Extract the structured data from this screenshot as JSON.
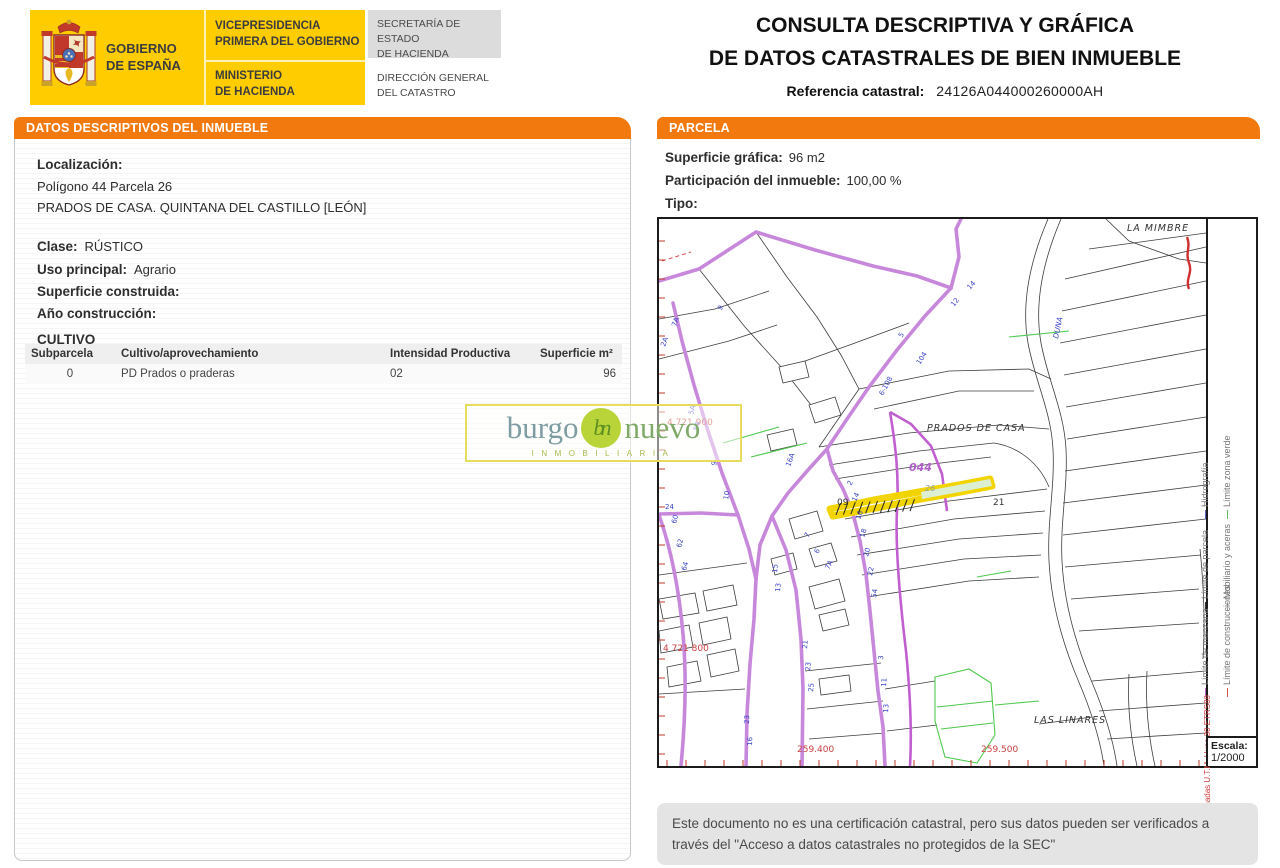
{
  "colors": {
    "accent_orange": "#F1790D",
    "gov_yellow": "#FFCC00",
    "highlight_yellow": "#F2D400"
  },
  "header": {
    "gobierno": "GOBIERNO\nDE ESPAÑA",
    "vicepresidencia": "VICEPRESIDENCIA\nPRIMERA DEL GOBIERNO",
    "ministerio": "MINISTERIO\nDE HACIENDA",
    "secretaria": "SECRETARÍA DE ESTADO\nDE HACIENDA",
    "direccion": "DIRECCIÓN GENERAL\nDEL CATASTRO",
    "title_line1": "CONSULTA DESCRIPTIVA Y GRÁFICA",
    "title_line2": "DE DATOS CATASTRALES DE BIEN INMUEBLE",
    "ref_label": "Referencia catastral:",
    "ref_value": "24126A044000260000AH"
  },
  "left_panel": {
    "header": "DATOS DESCRIPTIVOS DEL INMUEBLE",
    "localizacion_label": "Localización:",
    "localizacion_line1": "Polígono 44 Parcela 26",
    "localizacion_line2": "PRADOS DE CASA. QUINTANA DEL CASTILLO [LEÓN]",
    "clase_label": "Clase:",
    "clase_value": "RÚSTICO",
    "uso_label": "Uso principal:",
    "uso_value": "Agrario",
    "superficie_label": "Superficie construida:",
    "superficie_value": "",
    "ano_label": "Año construcción:",
    "ano_value": "",
    "cultivo_title": "CULTIVO",
    "table": {
      "headers": [
        "Subparcela",
        "Cultivo/aprovechamiento",
        "Intensidad Productiva",
        "Superficie m²"
      ],
      "rows": [
        [
          "0",
          "PD Prados o praderas",
          "02",
          "96"
        ]
      ]
    }
  },
  "right_panel": {
    "header": "PARCELA",
    "superficie_label": "Superficie gráfica:",
    "superficie_value": "96 m2",
    "participacion_label": "Participación del inmueble:",
    "participacion_value": "100,00 %",
    "tipo_label": "Tipo:",
    "tipo_value": ""
  },
  "map": {
    "place_labels": {
      "mimbre": "LA MIMBRE",
      "prados": "PRADOS DE CASA",
      "linares": "LAS LINARES"
    },
    "parcel_labels": {
      "p09": "09",
      "p21": "21",
      "p26": "26",
      "block": "044"
    },
    "coord_labels": {
      "north1": "4 721 900",
      "north2": "4 721 800",
      "east1": "259.400",
      "east2": "259.500"
    },
    "hydro_label": "DUNA",
    "legend": {
      "items": [
        {
          "label": "Hidrografía",
          "color": "#4A5BD0"
        },
        {
          "label": "Límite zona verde",
          "color": "#55BB55"
        },
        {
          "label": "Límite de parcela",
          "color": "#222222"
        },
        {
          "label": "Mobiliario y aceras",
          "color": "#999999"
        },
        {
          "label": "Límite de manzana",
          "color": "#C05FC9"
        },
        {
          "label": "Límite de construcciones",
          "color": "#D04040"
        }
      ],
      "coords_text": "259.600 Coordenadas U.T.M. Huso 30 ETRS89"
    },
    "escala_label": "Escala:",
    "escala_value": "1/2000",
    "road_numbers": [
      {
        "x": 62,
        "y": 92,
        "r": -55,
        "t": "9"
      },
      {
        "x": 17,
        "y": 108,
        "r": -70,
        "t": "7A"
      },
      {
        "x": 6,
        "y": 128,
        "r": -70,
        "t": "2A"
      },
      {
        "x": 34,
        "y": 196,
        "r": -75,
        "t": "5A"
      },
      {
        "x": 39,
        "y": 212,
        "r": -75,
        "t": "54"
      },
      {
        "x": 57,
        "y": 247,
        "r": -78,
        "t": "9"
      },
      {
        "x": 69,
        "y": 281,
        "r": -80,
        "t": "10"
      },
      {
        "x": 243,
        "y": 119,
        "r": -58,
        "t": "5"
      },
      {
        "x": 261,
        "y": 146,
        "r": -58,
        "t": "104"
      },
      {
        "x": 224,
        "y": 177,
        "r": -62,
        "t": "6-108"
      },
      {
        "x": 295,
        "y": 88,
        "r": -52,
        "t": "12"
      },
      {
        "x": 311,
        "y": 71,
        "r": -48,
        "t": "14"
      },
      {
        "x": 118,
        "y": 354,
        "r": -85,
        "t": "15"
      },
      {
        "x": 121,
        "y": 373,
        "r": -85,
        "t": "13"
      },
      {
        "x": 131,
        "y": 248,
        "r": -70,
        "t": "16A"
      },
      {
        "x": 149,
        "y": 319,
        "r": -60,
        "t": "7"
      },
      {
        "x": 159,
        "y": 335,
        "r": -62,
        "t": "6"
      },
      {
        "x": 170,
        "y": 351,
        "r": -64,
        "t": "7A"
      },
      {
        "x": 192,
        "y": 267,
        "r": -62,
        "t": "2"
      },
      {
        "x": 197,
        "y": 283,
        "r": -66,
        "t": "14"
      },
      {
        "x": 201,
        "y": 301,
        "r": -70,
        "t": "16"
      },
      {
        "x": 205,
        "y": 319,
        "r": -72,
        "t": "18"
      },
      {
        "x": 209,
        "y": 338,
        "r": -75,
        "t": "20"
      },
      {
        "x": 213,
        "y": 357,
        "r": -78,
        "t": "22"
      },
      {
        "x": 217,
        "y": 379,
        "r": -80,
        "t": "54"
      },
      {
        "x": 148,
        "y": 430,
        "r": -85,
        "t": "21"
      },
      {
        "x": 151,
        "y": 452,
        "r": -85,
        "t": "23"
      },
      {
        "x": 154,
        "y": 473,
        "r": -85,
        "t": "25"
      },
      {
        "x": 224,
        "y": 441,
        "r": -86,
        "t": "3"
      },
      {
        "x": 227,
        "y": 468,
        "r": -86,
        "t": "11"
      },
      {
        "x": 229,
        "y": 494,
        "r": -86,
        "t": "13"
      },
      {
        "x": 17,
        "y": 305,
        "r": -75,
        "t": "60"
      },
      {
        "x": 22,
        "y": 329,
        "r": -75,
        "t": "62"
      },
      {
        "x": 27,
        "y": 352,
        "r": -75,
        "t": "64"
      },
      {
        "x": 6,
        "y": 290,
        "r": 0,
        "t": "24"
      },
      {
        "x": 90,
        "y": 505,
        "r": -88,
        "t": "23"
      },
      {
        "x": 93,
        "y": 527,
        "r": -88,
        "t": "16"
      }
    ]
  },
  "watermark": {
    "word1": "burgo",
    "word2": "nuevo",
    "logo": "bn",
    "tagline": "INMOBILIARIA"
  },
  "disclaimer": "Este documento no es una certificación catastral, pero sus datos pueden ser verificados a través del \"Acceso a datos catastrales no protegidos de la SEC\""
}
